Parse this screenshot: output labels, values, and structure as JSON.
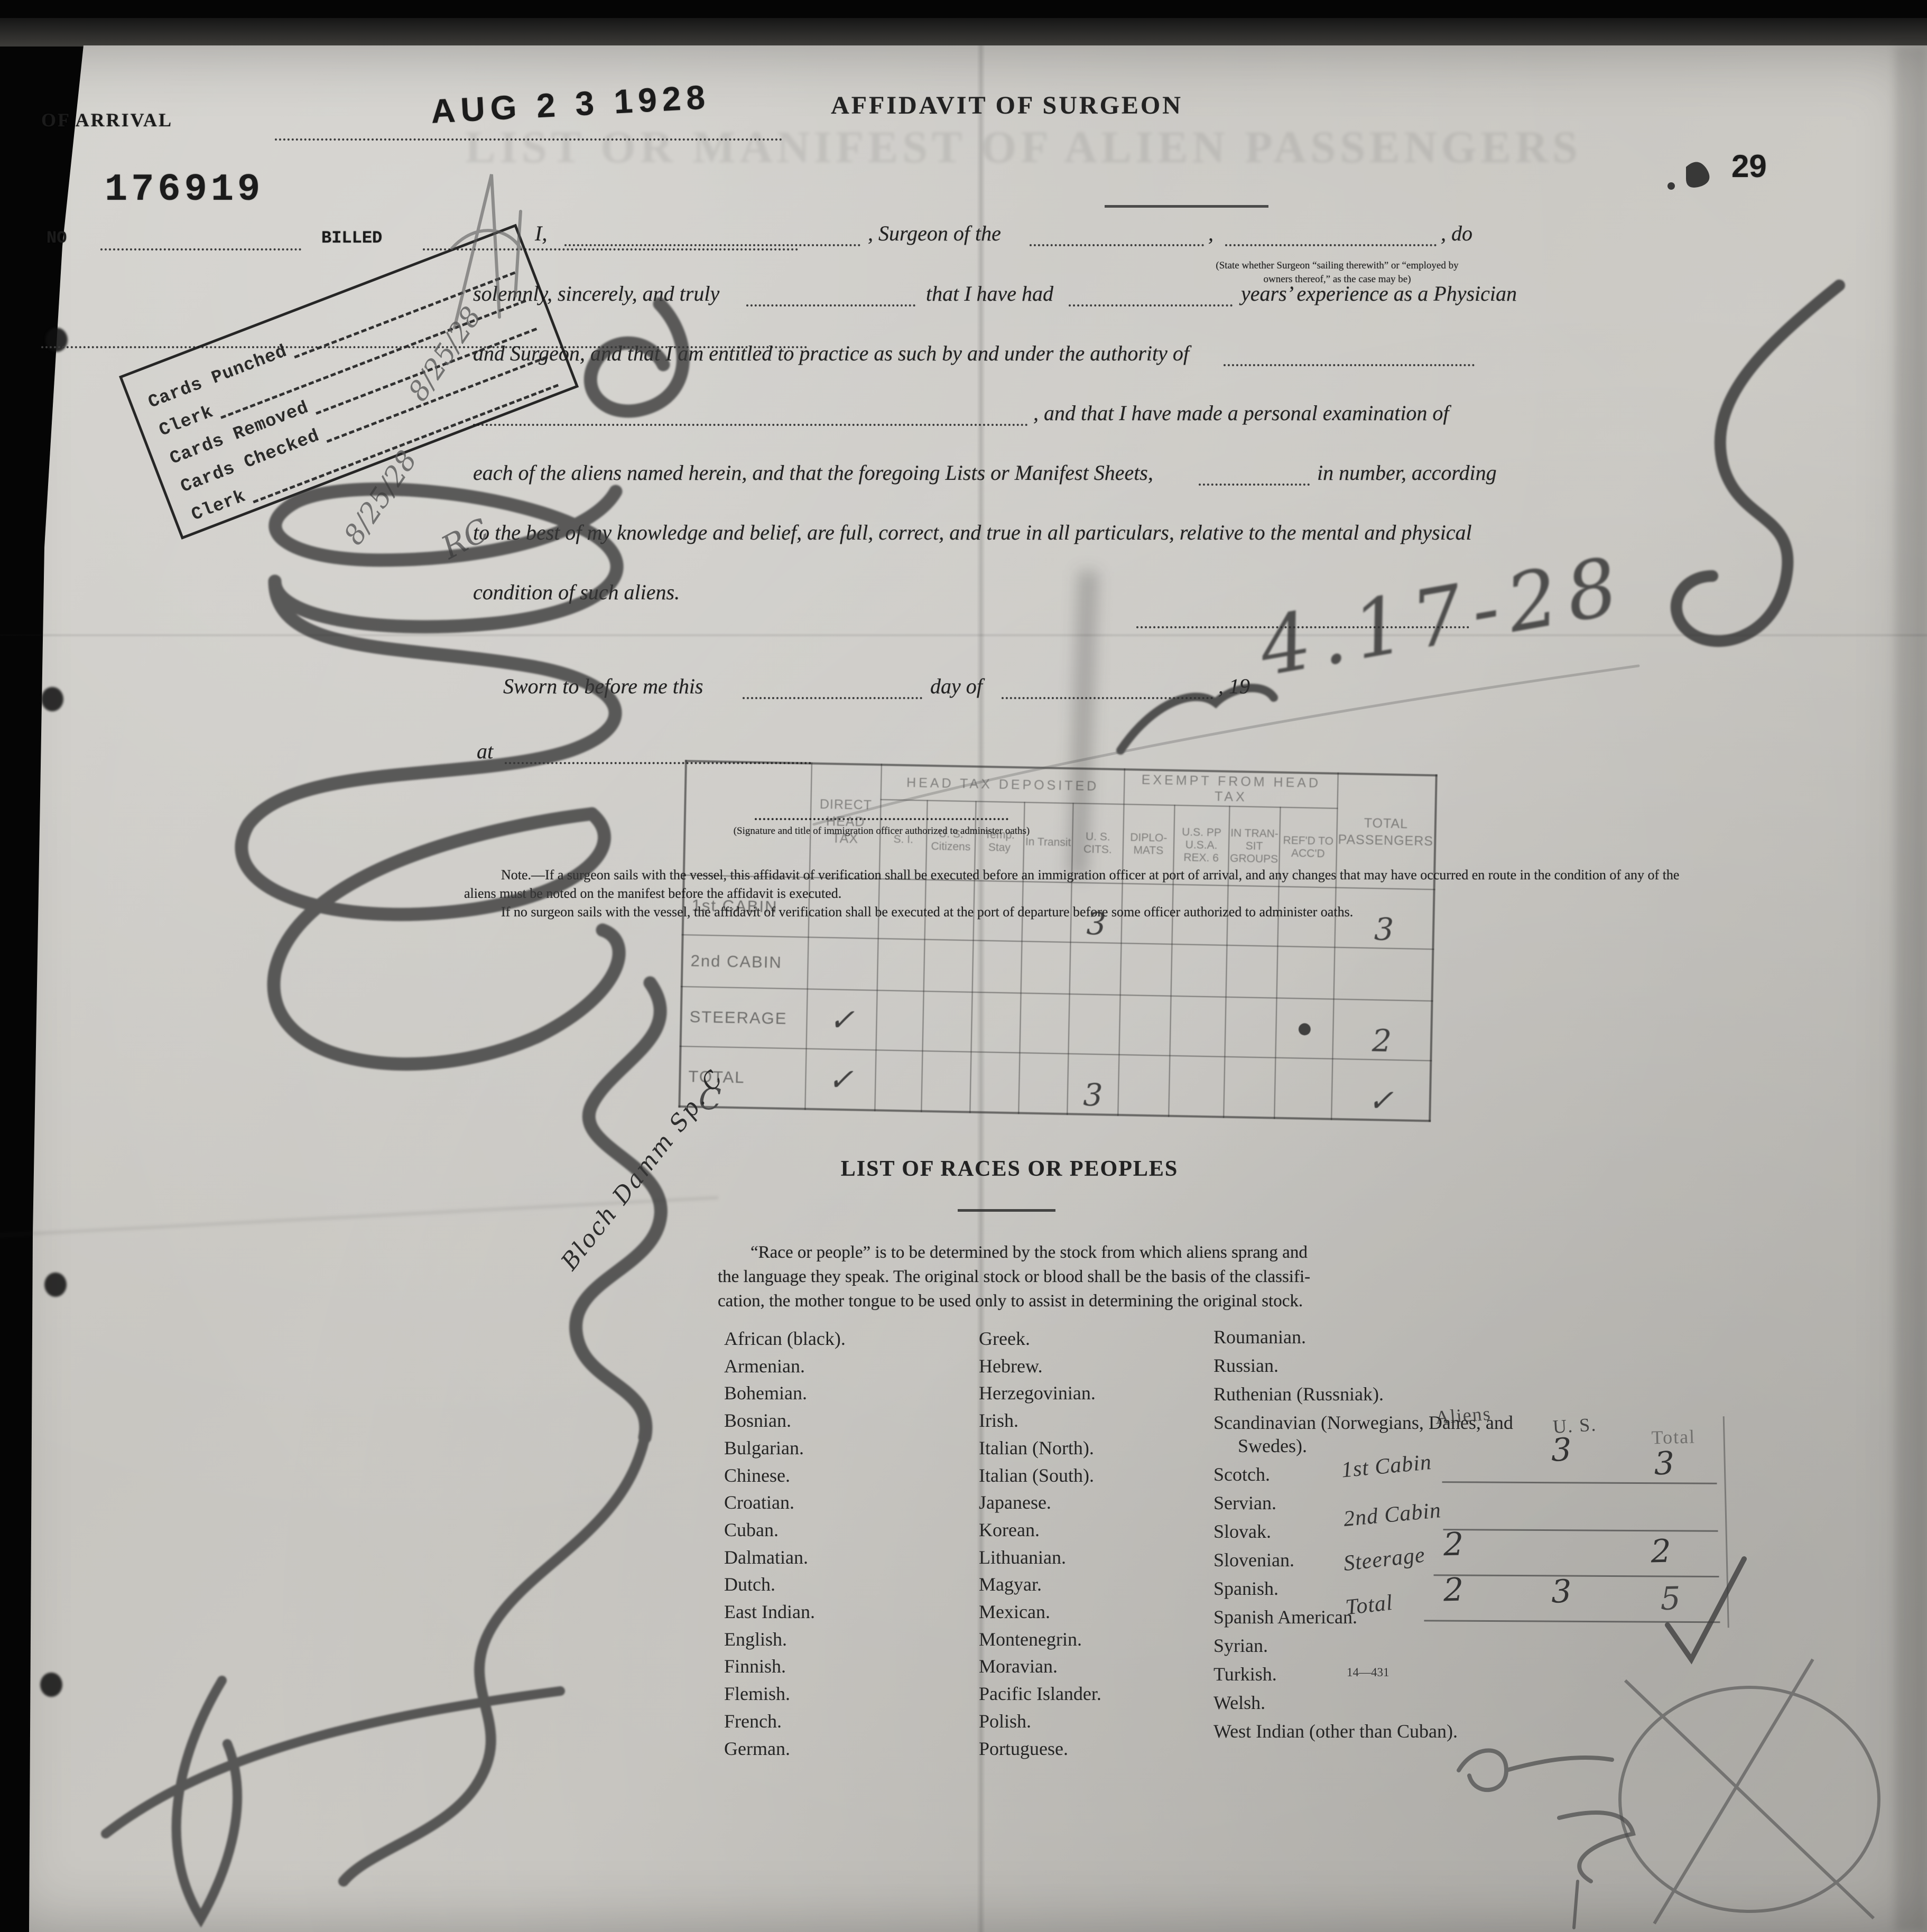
{
  "arrival": {
    "label": "OF ARRIVAL",
    "date_stamp": "AUG 2 3 1928",
    "serial_stamp": "176919",
    "no_label": "NO",
    "billed_label": "BILLED"
  },
  "page_stamp": "29",
  "ghost_banner": "LIST OR MANIFEST OF ALIEN PASSENGERS",
  "affidavit": {
    "title": "AFFIDAVIT OF SURGEON",
    "i_comma": "I,",
    "surgeon_of_the": ", Surgeon of the",
    "comma": ",",
    "do": ", do",
    "paren_note_1": "(State whether Surgeon “sailing therewith” or “employed by",
    "paren_note_2": "owners thereof,” as the case may be)",
    "line2_a": "solemnly, sincerely, and truly",
    "line2_b": "that I have had",
    "line2_c": "years’ experience as a Physician",
    "line3": "and Surgeon, and that I am entitled to practice as such by and under the authority of",
    "line4": ", and that I have made a personal examination of",
    "line5_a": "each of the aliens named herein, and that the foregoing Lists or Manifest Sheets,",
    "line5_b": "in number, according",
    "line6": "to the best of my knowledge and belief, are full, correct, and true in all particulars, relative to the mental and physical",
    "line7": "condition of such aliens.",
    "sworn_a": "Sworn to before me this",
    "sworn_b": "day of",
    "sworn_c": ", 19",
    "at_label": "at",
    "sig_caption": "(Signature and title of immigration officer authorized to administer oaths)",
    "note_1": "Note.—If a surgeon sails with the vessel, this affidavit of verification shall be executed before an immigration officer at port of arrival, and any changes that may have occurred en route in the condition of any of the aliens must be noted on the manifest before the affidavit is executed.",
    "note_2": "If no surgeon sails with the vessel, the affidavit of verification shall be executed at the port of departure before some officer authorized to administer oaths."
  },
  "clerk_box": {
    "rows": [
      "Cards Punched",
      "Clerk",
      "Cards Removed",
      "Cards Checked",
      "Clerk"
    ],
    "hand_date_1": "8/25/28",
    "hand_date_2": "8/25/28",
    "hand_initials": "RC"
  },
  "head_tax": {
    "col_direct": "DIRECT HEAD TAX",
    "group_deposited": "HEAD TAX DEPOSITED",
    "group_exempt": "EXEMPT FROM HEAD TAX",
    "dep_cols": [
      "S. I.",
      "U. S. Citizens",
      "Temp. Stay",
      "In Transit",
      "U. S. CITS."
    ],
    "ex_cols": [
      "DIPLO- MATS",
      "U.S. PP U.S.A. REX. 6",
      "IN TRAN- SIT GROUPS",
      "REF'D TO ACC'D"
    ],
    "col_total": "TOTAL PASSENGERS",
    "rows": [
      {
        "label": "1st CABIN",
        "cells": [
          "",
          "",
          "",
          "",
          "",
          "3",
          "",
          "",
          "",
          "",
          "3"
        ]
      },
      {
        "label": "2nd CABIN",
        "cells": [
          "",
          "",
          "",
          "",
          "",
          "",
          "",
          "",
          "",
          "",
          ""
        ]
      },
      {
        "label": "STEERAGE",
        "cells": [
          "✓",
          "",
          "",
          "",
          "",
          "",
          "",
          "",
          "",
          "●",
          "2"
        ]
      },
      {
        "label": "TOTAL",
        "cells": [
          "✓",
          "",
          "",
          "",
          "",
          "3",
          "",
          "",
          "",
          "",
          "✓"
        ]
      }
    ]
  },
  "races": {
    "title": "LIST OF RACES OR PEOPLES",
    "intro_1": "“Race or people” is to be determined by the stock from which aliens sprang and",
    "intro_2": "the language they speak.  The original stock or blood shall be the basis of the classifi-",
    "intro_3": "cation, the mother tongue to be used only to assist in determining the original stock.",
    "col1": [
      "African (black).",
      "Armenian.",
      "Bohemian.",
      "Bosnian.",
      "Bulgarian.",
      "Chinese.",
      "Croatian.",
      "Cuban.",
      "Dalmatian.",
      "Dutch.",
      "East Indian.",
      "English.",
      "Finnish.",
      "Flemish.",
      "French.",
      "German."
    ],
    "col2": [
      "Greek.",
      "Hebrew.",
      "Herzegovinian.",
      "Irish.",
      "Italian (North).",
      "Italian (South).",
      "Japanese.",
      "Korean.",
      "Lithuanian.",
      "Magyar.",
      "Mexican.",
      "Montenegrin.",
      "Moravian.",
      "Pacific Islander.",
      "Polish.",
      "Portuguese."
    ],
    "col3": [
      "Roumanian.",
      "Russian.",
      "Ruthenian (Russniak).",
      "Scandinavian (Norwegians, Danes, and Swedes).",
      "Scotch.",
      "Servian.",
      "Slovak.",
      "Slovenian.",
      "Spanish.",
      "Spanish American.",
      "Syrian.",
      "Turkish.",
      "Welsh.",
      "West Indian (other than Cuban)."
    ]
  },
  "tally": {
    "headers": [
      "Aliens",
      "U. S.",
      "Total"
    ],
    "rows": [
      {
        "label": "1st Cabin",
        "aliens": "",
        "us": "3",
        "total": "3"
      },
      {
        "label": "2nd Cabin",
        "aliens": "",
        "us": "",
        "total": ""
      },
      {
        "label": "Steerage",
        "aliens": "2",
        "us": "",
        "total": "2"
      },
      {
        "label": "Total",
        "aliens": "2",
        "us": "3",
        "total": "5"
      }
    ]
  },
  "misc": {
    "form_number": "14—431",
    "hand_c": "C",
    "date_scrawl": "4.17-28",
    "diagonal_signature": "Bloch Damm Sp. C"
  }
}
